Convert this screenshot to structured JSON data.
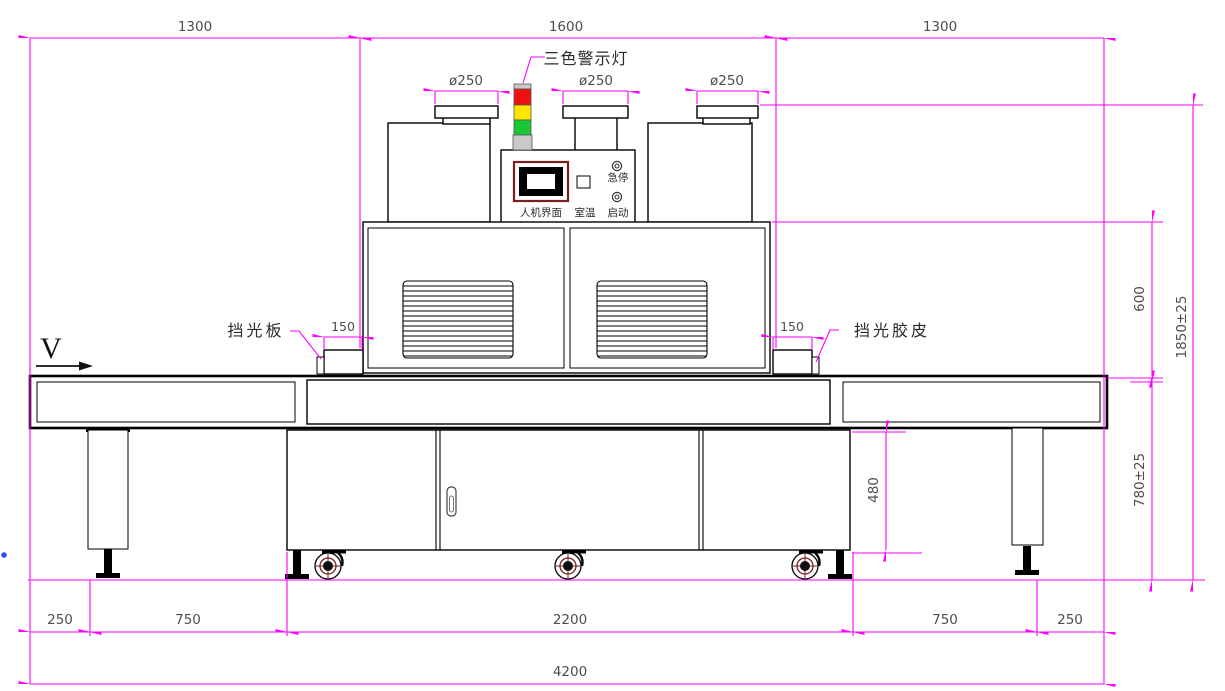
{
  "drawing": {
    "labels": {
      "warning_light": "三色警示灯",
      "left_shield": "挡光板",
      "right_shield": "挡光胶皮",
      "view": "V",
      "hmi": "人机界面",
      "room_temp": "室温",
      "estop": "急停",
      "start": "启动"
    },
    "dims": {
      "top": [
        "1300",
        "1600",
        "1300"
      ],
      "ducts": [
        "ø250",
        "ø250",
        "ø250"
      ],
      "shield": [
        "150",
        "150"
      ],
      "side": {
        "oven_height": "600",
        "total_height": "1850±25",
        "table_height": "780±25",
        "cabinet_height": "480"
      },
      "bottom": [
        "250",
        "750",
        "2200",
        "750",
        "250"
      ],
      "overall_width": "4200"
    },
    "colors": {
      "dimension": "#ff00ff",
      "outline": "#000000",
      "dim_text": "#4d4d4d",
      "lamp_red": "#ee1111",
      "lamp_yellow": "#ffe600",
      "lamp_green": "#18c832",
      "lamp_gray": "#c9c9c9",
      "dark_red": "#7a1f1f",
      "stray_dot": "#2e4bff"
    }
  }
}
